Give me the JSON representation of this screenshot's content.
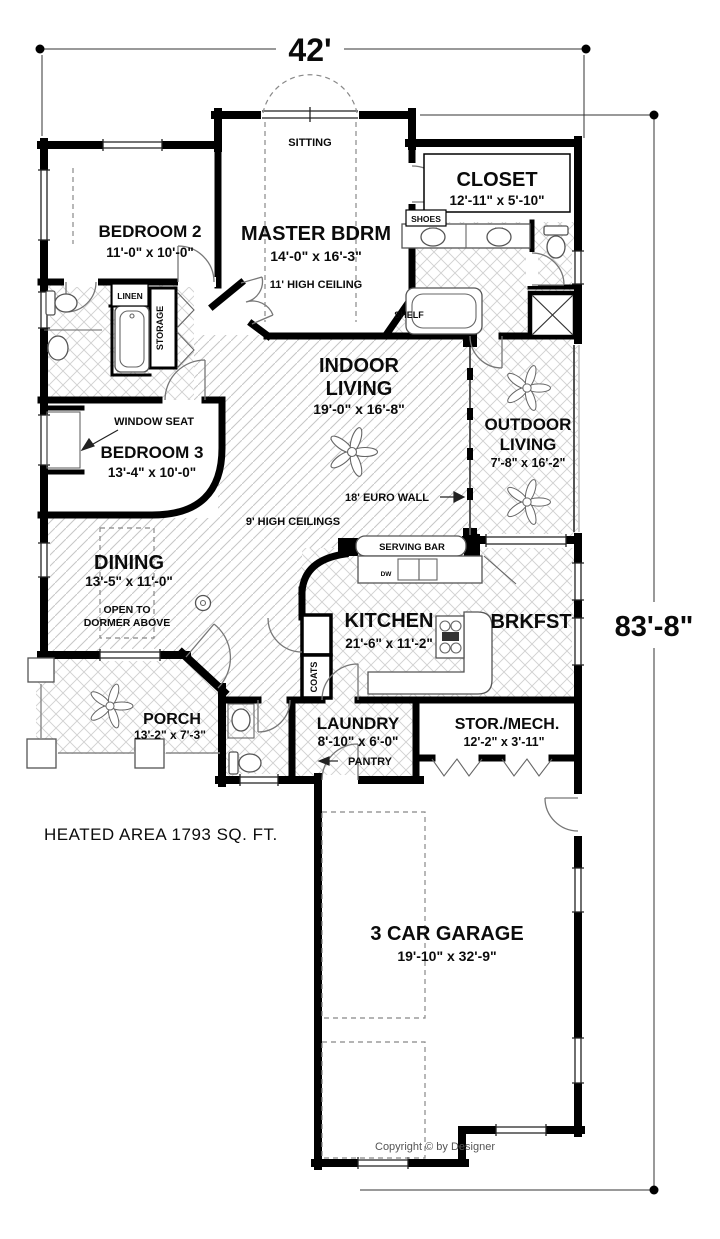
{
  "dims": {
    "width": "42'",
    "depth": "83'-8\""
  },
  "rooms": {
    "bedroom2": {
      "name": "BEDROOM 2",
      "size": "11'-0\" x 10'-0\""
    },
    "master": {
      "name": "MASTER BDRM",
      "size": "14'-0\" x 16'-3\"",
      "ceiling": "11' HIGH CEILING",
      "sitting": "SITTING"
    },
    "closet": {
      "name": "CLOSET",
      "size": "12'-11\" x 5'-10\""
    },
    "indoor_living": {
      "line1": "INDOOR",
      "line2": "LIVING",
      "size": "19'-0\" x 16'-8\""
    },
    "outdoor_living": {
      "line1": "OUTDOOR",
      "line2": "LIVING",
      "size": "7'-8\" x 16'-2\""
    },
    "bedroom3": {
      "name": "BEDROOM 3",
      "size": "13'-4\" x 10'-0\""
    },
    "dining": {
      "name": "DINING",
      "size": "13'-5\" x 11'-0\"",
      "note1": "OPEN TO",
      "note2": "DORMER ABOVE"
    },
    "kitchen": {
      "name": "KITCHEN",
      "size": "21'-6\" x 11'-2\""
    },
    "brkfst": {
      "name": "BRKFST"
    },
    "porch": {
      "name": "PORCH",
      "size": "13'-2\" x 7'-3\""
    },
    "laundry": {
      "name": "LAUNDRY",
      "size": "8'-10\" x 6'-0\""
    },
    "stor_mech": {
      "name": "STOR./MECH.",
      "size": "12'-2\" x 3'-11\""
    },
    "garage": {
      "name": "3 CAR GARAGE",
      "size": "19'-10\" x 32'-9\""
    }
  },
  "labels": {
    "shoes": "SHOES",
    "linen": "LINEN",
    "storage": "STORAGE",
    "shelf": "SHELF",
    "window_seat": "WINDOW SEAT",
    "euro_wall": "18' EURO WALL",
    "high_ceilings": "9' HIGH CEILINGS",
    "serving_bar": "SERVING BAR",
    "coats": "COATS",
    "pantry": "PANTRY",
    "dw": "DW"
  },
  "footer": {
    "heated_area": "HEATED AREA  1793 SQ. FT.",
    "copyright": "Copyright © by Designer"
  }
}
